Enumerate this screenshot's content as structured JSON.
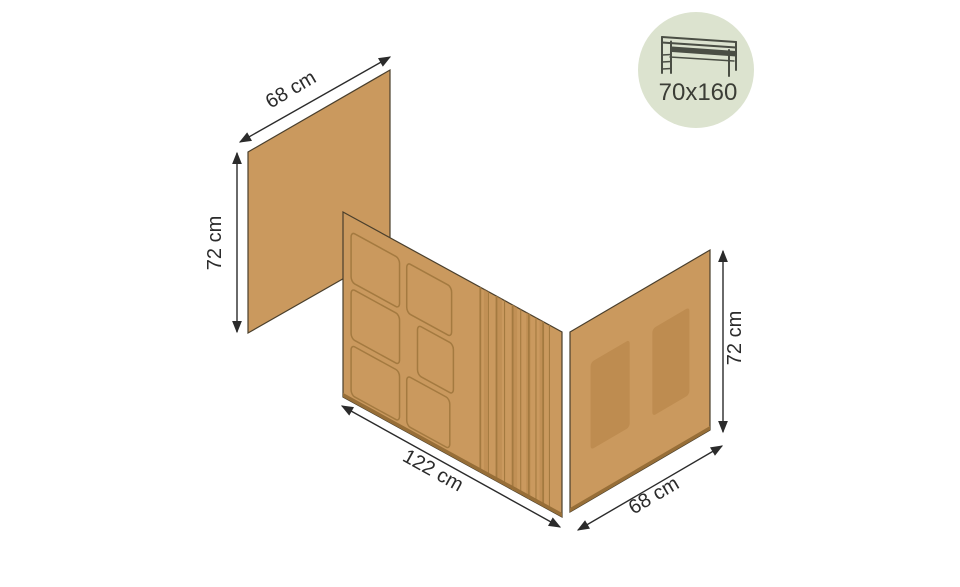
{
  "dimensions": {
    "left_panel": {
      "width_label": "68 cm",
      "height_label": "72 cm"
    },
    "front_panel": {
      "width_label": "122 cm"
    },
    "right_panel": {
      "width_label": "68 cm",
      "height_label": "72 cm"
    }
  },
  "badge": {
    "size_label": "70x160",
    "icon": "loft-bed-icon",
    "bg_color": "#dce3cf",
    "fg_color": "#3b3d36"
  },
  "colors": {
    "fabric": "#ca995e",
    "fabric_shadow": "#be8c50",
    "pleat_band": "#b9894e",
    "stitch": "#a47a40",
    "hem_band": "#976e37",
    "outline": "#4a3f2c",
    "dimension_ink": "#2b2b2b"
  }
}
